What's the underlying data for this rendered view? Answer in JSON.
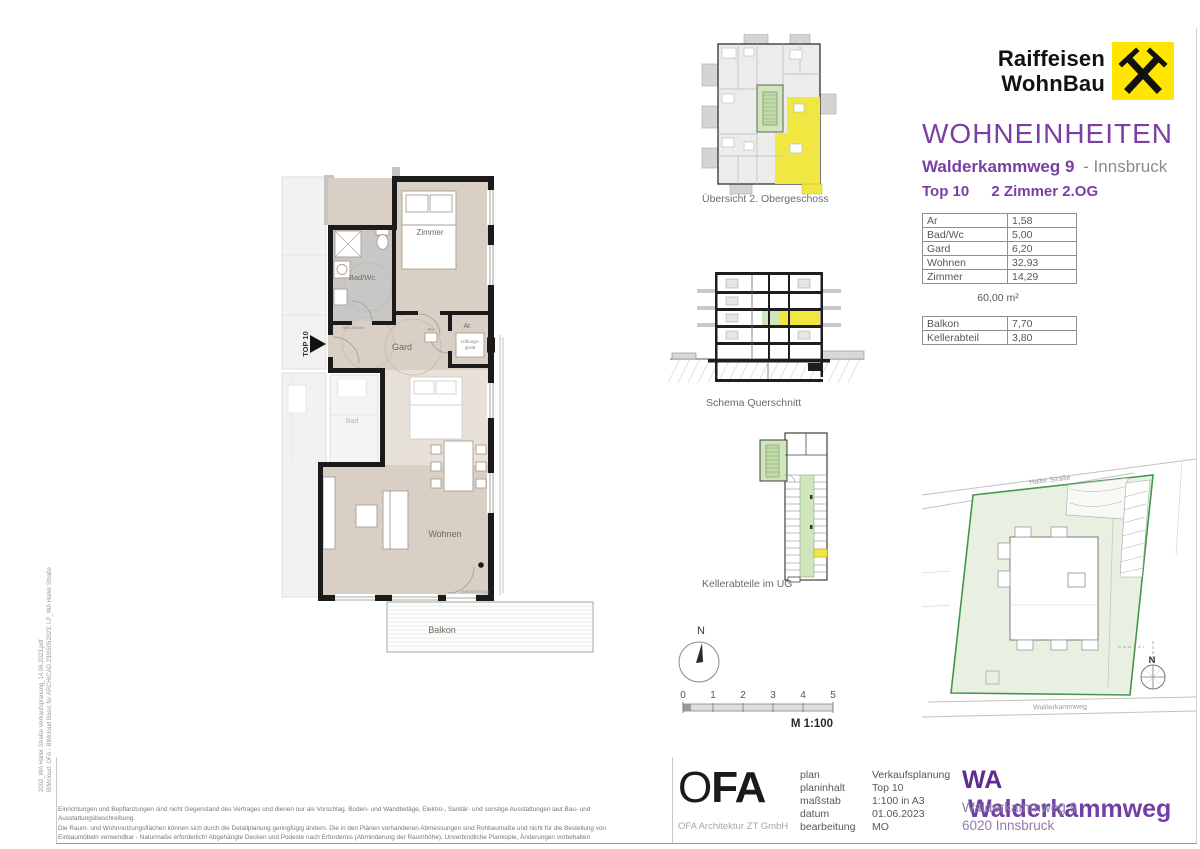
{
  "colors": {
    "accent_purple": "#7b3fa3",
    "raiffeisen_yellow": "#ffe500",
    "highlight_yellow": "#f1e742",
    "highlight_green": "#cfe6bb",
    "floor_beige": "#d9cfc5",
    "site_green_border": "#45984b"
  },
  "header": {
    "logo": {
      "line1": "Raiffeisen",
      "line2": "WohnBau"
    },
    "title": "WOHNEINHEITEN",
    "subtitle_bold": "Walderkammweg 9",
    "subtitle_rest": "- Innsbruck",
    "unit_no": "Top 10",
    "unit_type": "2 Zimmer 2.OG"
  },
  "tables": {
    "area": {
      "rows": [
        {
          "label": "Ar",
          "value": "1,58"
        },
        {
          "label": "Bad/Wc",
          "value": "5,00"
        },
        {
          "label": "Gard",
          "value": "6,20"
        },
        {
          "label": "Wohnen",
          "value": "32,93"
        },
        {
          "label": "Zimmer",
          "value": "14,29"
        }
      ],
      "total": "60,00 m²"
    },
    "extra": {
      "rows": [
        {
          "label": "Balkon",
          "value": "7,70"
        },
        {
          "label": "Kellerabteil",
          "value": "3,80"
        }
      ]
    }
  },
  "floorplan": {
    "entry_label": "TOP 10",
    "rooms": {
      "zimmer": "Zimmer",
      "bad": "Bad/Wc",
      "gard": "Gard",
      "ar": "Ar",
      "wohnen": "Wohnen",
      "balkon": "Balkon"
    },
    "annotations": {
      "lueftung_1": "Lüftungs-",
      "lueftung_2": "gerät",
      "ev": "EV",
      "hwt": "HWT-Nische",
      "entwaesserung": "Entwässerung",
      "neighbor_bad": "Bad"
    }
  },
  "diagrams": {
    "uebersicht_caption": "Übersicht 2. Obergeschoss",
    "querschnitt_caption": "Schema Querschnitt",
    "keller_caption": "Kellerabteile im UG",
    "compass_n": "N",
    "scale": {
      "ticks": [
        "0",
        "1",
        "2",
        "3",
        "4",
        "5"
      ],
      "label": "M 1:100"
    }
  },
  "siteplan": {
    "street_top": "Haller Straße",
    "street_bottom": "Walderkammweg",
    "compass_n": "N"
  },
  "footer": {
    "ofa_logo_o": "O",
    "ofa_logo_fa": "FA",
    "ofa_sub": "OFA Architektur ZT GmbH",
    "labels": {
      "plan": "plan",
      "planinhalt": "planinhalt",
      "massstab": "maßstab",
      "datum": "datum",
      "bearbeitung": "bearbeitung"
    },
    "values": {
      "plan": "Verkaufsplanung",
      "planinhalt": "Top 10",
      "massstab": "1:100 in A3",
      "datum": "01.06.2023",
      "bearbeitung": "MO"
    },
    "project_bold": "WA",
    "project_name": "Walderkammweg",
    "address_line1": "Walderkammweg 9",
    "address_line2": "6020 Innsbruck"
  },
  "disclaimer": {
    "line1": "Einrichtungen und Bepflanzungen sind nicht Gegenstand des Vertrages und dienen nur als Vorschlag. Boden- und Wandbeläge, Elektro-, Sanitär- und sonstige Ausstattungen laut Bau- und Ausstattungsbeschreibung.",
    "line2": "Die Raum- und Wohnnutzungsflächen können sich durch die Detailplanung geringfügig ändern. Die in den Plänen vorhandenen Abmessungen sind Rohbaumaße und nicht für die Bestellung von",
    "line3": "Einbaumöbeln verwendbar - Naturmaße erforderlich! Abgehängte Decken und Podeste nach Erfordernis (Abminderung der Raumhöhe). Unverbindliche Plankopie, Änderungen vorbehalten"
  },
  "side_note": {
    "line1": "2002_WA Haller Straße Verkaufsplanung_14.06.2023.pdf",
    "line2": "BIMcloud: OFA - BIMcloud Basic für ARCHICAD 23/05052023; LP_WA Haller Straße"
  }
}
